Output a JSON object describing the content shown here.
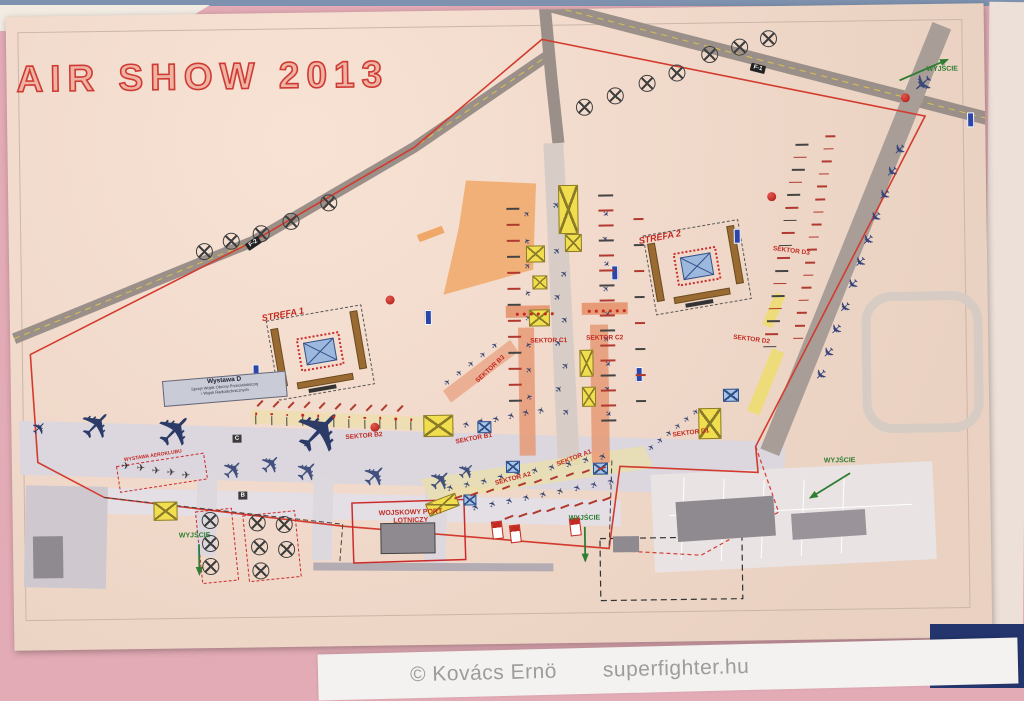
{
  "photo": {
    "caption_copyright": "© Kovács Ernö",
    "caption_site": "superfighter.hu"
  },
  "map": {
    "title": "AIR SHOW 2013",
    "roads": {
      "f1": "F-1",
      "f2": "F-2",
      "taxi_c": "C",
      "taxi_b": "B"
    },
    "zones": {
      "strefa1": "STREFA 1",
      "strefa2": "STREFA 2"
    },
    "sectors": [
      "SEKTOR A1",
      "SEKTOR A2",
      "SEKTOR B1",
      "SEKTOR B2",
      "SEKTOR B3",
      "SEKTOR C1",
      "SEKTOR C2",
      "SEKTOR D1",
      "SEKTOR D2",
      "SEKTOR D3"
    ],
    "exit_label": "WYJŚCIE",
    "exhibits": {
      "wystawa_d_title": "Wystawa D",
      "wystawa_d_line1": "Sprzęt Wojsk Obrony Przeciwlotniczej",
      "wystawa_d_line2": "i Wojsk Radiotechnicznych",
      "aeroklub": "WYSTAWA AEROKLUBU"
    },
    "buildings": {
      "port_line1": "WOJSKOWY PORT",
      "port_line2": "LOTNICZY"
    },
    "icons": {
      "aircraft-icon": "dark-blue airplane silhouette",
      "helicopter-icon": "circle with rotor cross",
      "display-stand-icon": "yellow crossed box",
      "exhibit-tent-icon": "blue crossed box",
      "toilet-marker-icon": "blue bar",
      "info-marker-icon": "red ball",
      "exit-arrow-icon": "green arrow"
    },
    "colors": {
      "paper": "#f6dccb",
      "photo_bg": "#e3abb5",
      "boundary_red": "#d23b2e",
      "road_gray": "#9b9089",
      "apron": "#dcd6de",
      "aircraft_navy": "#2b3a66",
      "stand_yellow": "#f1de4e",
      "zone_orange": "#efa061",
      "exit_green": "#2e7d32",
      "grandstand_brown": "#9a6a33",
      "caption_gray": "#9d9c9c",
      "corner_navy": "#24356d"
    }
  }
}
